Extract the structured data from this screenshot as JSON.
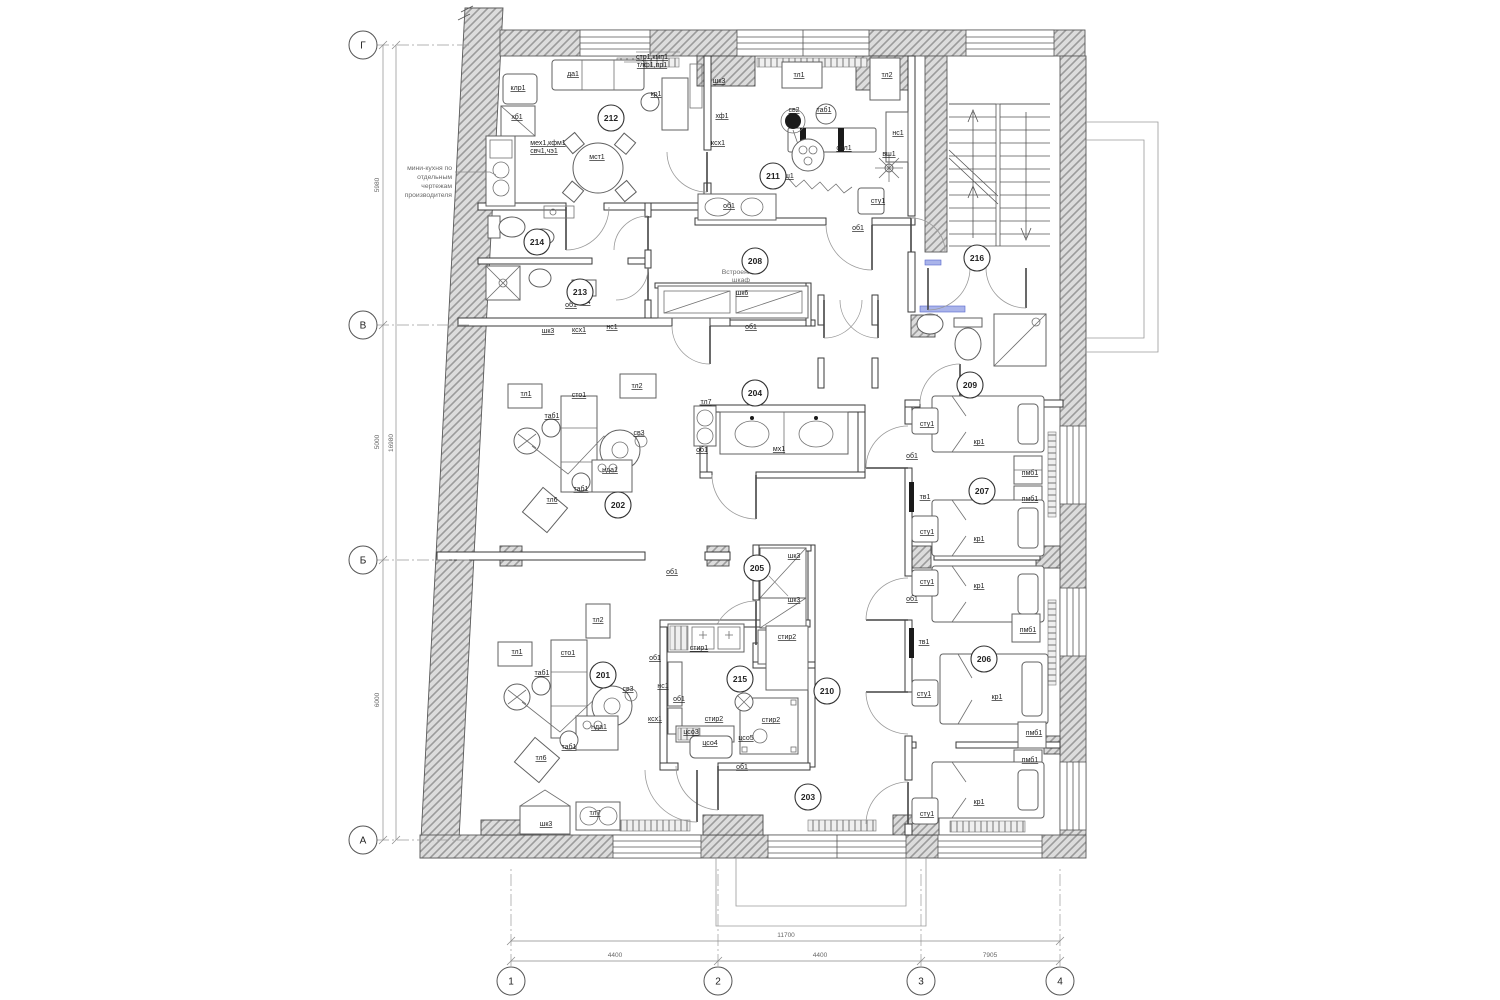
{
  "colors": {
    "wall_hatch_bg": "#dcdcdc",
    "wall_hatch_line": "#9b9b9b",
    "line": "#3a3a3a",
    "accent_blue": "#aab4ea"
  },
  "grid": {
    "rows": [
      {
        "label": "Г",
        "y": 45
      },
      {
        "label": "В",
        "y": 325
      },
      {
        "label": "Б",
        "y": 560
      },
      {
        "label": "А",
        "y": 840
      }
    ],
    "cols": [
      {
        "label": "1",
        "x": 511
      },
      {
        "label": "2",
        "x": 718
      },
      {
        "label": "3",
        "x": 921
      },
      {
        "label": "4",
        "x": 1060
      }
    ]
  },
  "dimensions": {
    "vertical_segments": [
      {
        "value": "5980",
        "y": 185
      },
      {
        "value": "5000",
        "y": 442
      },
      {
        "value": "6000",
        "y": 700
      }
    ],
    "vertical_overall": {
      "value": "16980",
      "y": 443
    },
    "horizontal_segments": [
      {
        "value": "4400",
        "x": 615
      },
      {
        "value": "4400",
        "x": 820
      },
      {
        "value": "7905",
        "x": 990
      }
    ],
    "horizontal_overall": {
      "value": "11700",
      "x": 786
    }
  },
  "rooms": [
    {
      "number": "201",
      "x": 603,
      "y": 675
    },
    {
      "number": "202",
      "x": 618,
      "y": 505
    },
    {
      "number": "203",
      "x": 808,
      "y": 797
    },
    {
      "number": "204",
      "x": 755,
      "y": 393
    },
    {
      "number": "205",
      "x": 757,
      "y": 568
    },
    {
      "number": "206",
      "x": 984,
      "y": 659
    },
    {
      "number": "207",
      "x": 982,
      "y": 491
    },
    {
      "number": "208",
      "x": 755,
      "y": 261
    },
    {
      "number": "209",
      "x": 970,
      "y": 385
    },
    {
      "number": "210",
      "x": 827,
      "y": 691
    },
    {
      "number": "211",
      "x": 773,
      "y": 176
    },
    {
      "number": "212",
      "x": 611,
      "y": 118
    },
    {
      "number": "213",
      "x": 580,
      "y": 292
    },
    {
      "number": "214",
      "x": 537,
      "y": 242
    },
    {
      "number": "215",
      "x": 740,
      "y": 679
    },
    {
      "number": "216",
      "x": 977,
      "y": 258
    }
  ],
  "notes": [
    {
      "text": "мини-кухня по",
      "x": 452,
      "y": 170,
      "anchor": "end"
    },
    {
      "text": "отдельным",
      "x": 452,
      "y": 179,
      "anchor": "end"
    },
    {
      "text": "чертежам",
      "x": 452,
      "y": 188,
      "anchor": "end"
    },
    {
      "text": "производителя",
      "x": 452,
      "y": 197,
      "anchor": "end"
    },
    {
      "text": "Встроенный",
      "x": 741,
      "y": 274,
      "anchor": "middle"
    },
    {
      "text": "шкаф",
      "x": 741,
      "y": 282,
      "anchor": "middle"
    }
  ],
  "furniture_labels": [
    {
      "text": "да1",
      "x": 573,
      "y": 76
    },
    {
      "text": "клр1",
      "x": 518,
      "y": 90
    },
    {
      "text": "хб1",
      "x": 517,
      "y": 119
    },
    {
      "text": "стр1,кмп1",
      "x": 652,
      "y": 59
    },
    {
      "text": "тлф1,пр1",
      "x": 652,
      "y": 67
    },
    {
      "text": "кр1",
      "x": 656,
      "y": 96
    },
    {
      "text": "мех1,кфм1",
      "x": 548,
      "y": 145
    },
    {
      "text": "свч1,чэ1",
      "x": 544,
      "y": 153
    },
    {
      "text": "мст1",
      "x": 597,
      "y": 159
    },
    {
      "text": "шк3",
      "x": 719,
      "y": 83
    },
    {
      "text": "хф1",
      "x": 722,
      "y": 118
    },
    {
      "text": "ксх1",
      "x": 718,
      "y": 145
    },
    {
      "text": "тл1",
      "x": 799,
      "y": 77
    },
    {
      "text": "тл2",
      "x": 887,
      "y": 77
    },
    {
      "text": "св2",
      "x": 794,
      "y": 112
    },
    {
      "text": "таб1",
      "x": 824,
      "y": 112
    },
    {
      "text": "спл1",
      "x": 844,
      "y": 150
    },
    {
      "text": "нс1",
      "x": 898,
      "y": 135
    },
    {
      "text": "вш1",
      "x": 889,
      "y": 156
    },
    {
      "text": "ш1",
      "x": 789,
      "y": 178
    },
    {
      "text": "сту1",
      "x": 878,
      "y": 203
    },
    {
      "text": "об1",
      "x": 729,
      "y": 208
    },
    {
      "text": "об1",
      "x": 858,
      "y": 230
    },
    {
      "text": "об1",
      "x": 571,
      "y": 307
    },
    {
      "text": "тл4",
      "x": 585,
      "y": 304
    },
    {
      "text": "шк3",
      "x": 548,
      "y": 333
    },
    {
      "text": "ксх1",
      "x": 579,
      "y": 332
    },
    {
      "text": "нс1",
      "x": 612,
      "y": 329
    },
    {
      "text": "шк6",
      "x": 742,
      "y": 295
    },
    {
      "text": "об1",
      "x": 751,
      "y": 329
    },
    {
      "text": "тл1",
      "x": 526,
      "y": 396
    },
    {
      "text": "сто1",
      "x": 579,
      "y": 397
    },
    {
      "text": "тл2",
      "x": 637,
      "y": 388
    },
    {
      "text": "таб1",
      "x": 552,
      "y": 418
    },
    {
      "text": "св3",
      "x": 639,
      "y": 435
    },
    {
      "text": "нда1",
      "x": 610,
      "y": 472
    },
    {
      "text": "таб1",
      "x": 581,
      "y": 491
    },
    {
      "text": "тл6",
      "x": 552,
      "y": 502
    },
    {
      "text": "об1",
      "x": 672,
      "y": 574
    },
    {
      "text": "тл7",
      "x": 706,
      "y": 404
    },
    {
      "text": "об1",
      "x": 702,
      "y": 452
    },
    {
      "text": "мх1",
      "x": 779,
      "y": 451
    },
    {
      "text": "шк3",
      "x": 794,
      "y": 558
    },
    {
      "text": "шк3",
      "x": 794,
      "y": 602
    },
    {
      "text": "стир2",
      "x": 787,
      "y": 639
    },
    {
      "text": "сту1",
      "x": 927,
      "y": 426
    },
    {
      "text": "кр1",
      "x": 979,
      "y": 444
    },
    {
      "text": "об1",
      "x": 912,
      "y": 458
    },
    {
      "text": "пмб1",
      "x": 1030,
      "y": 475
    },
    {
      "text": "пмб1",
      "x": 1030,
      "y": 501
    },
    {
      "text": "тв1",
      "x": 925,
      "y": 499
    },
    {
      "text": "сту1",
      "x": 927,
      "y": 534
    },
    {
      "text": "кр1",
      "x": 979,
      "y": 541
    },
    {
      "text": "сту1",
      "x": 927,
      "y": 584
    },
    {
      "text": "кр1",
      "x": 979,
      "y": 588
    },
    {
      "text": "об1",
      "x": 912,
      "y": 601
    },
    {
      "text": "пмб1",
      "x": 1028,
      "y": 632
    },
    {
      "text": "тв1",
      "x": 924,
      "y": 644
    },
    {
      "text": "сту1",
      "x": 924,
      "y": 696
    },
    {
      "text": "кр1",
      "x": 997,
      "y": 699
    },
    {
      "text": "пмб1",
      "x": 1034,
      "y": 735
    },
    {
      "text": "пмб1",
      "x": 1030,
      "y": 762
    },
    {
      "text": "кр1",
      "x": 979,
      "y": 804
    },
    {
      "text": "сту1",
      "x": 927,
      "y": 816
    },
    {
      "text": "тл2",
      "x": 598,
      "y": 622
    },
    {
      "text": "тл1",
      "x": 517,
      "y": 654
    },
    {
      "text": "сто1",
      "x": 568,
      "y": 655
    },
    {
      "text": "таб1",
      "x": 542,
      "y": 675
    },
    {
      "text": "св3",
      "x": 628,
      "y": 691
    },
    {
      "text": "нда1",
      "x": 599,
      "y": 729
    },
    {
      "text": "таб1",
      "x": 569,
      "y": 749
    },
    {
      "text": "тл6",
      "x": 541,
      "y": 760
    },
    {
      "text": "тл7",
      "x": 595,
      "y": 815
    },
    {
      "text": "шк3",
      "x": 546,
      "y": 826
    },
    {
      "text": "стир1",
      "x": 699,
      "y": 650
    },
    {
      "text": "об1",
      "x": 655,
      "y": 660
    },
    {
      "text": "нс1",
      "x": 663,
      "y": 688
    },
    {
      "text": "об1",
      "x": 679,
      "y": 701
    },
    {
      "text": "ксх1",
      "x": 655,
      "y": 721
    },
    {
      "text": "стир2",
      "x": 714,
      "y": 721
    },
    {
      "text": "стир2",
      "x": 771,
      "y": 722
    },
    {
      "text": "цсо3",
      "x": 691,
      "y": 734
    },
    {
      "text": "цсо4",
      "x": 710,
      "y": 745
    },
    {
      "text": "цсо5",
      "x": 746,
      "y": 740
    },
    {
      "text": "об1",
      "x": 742,
      "y": 769
    }
  ]
}
